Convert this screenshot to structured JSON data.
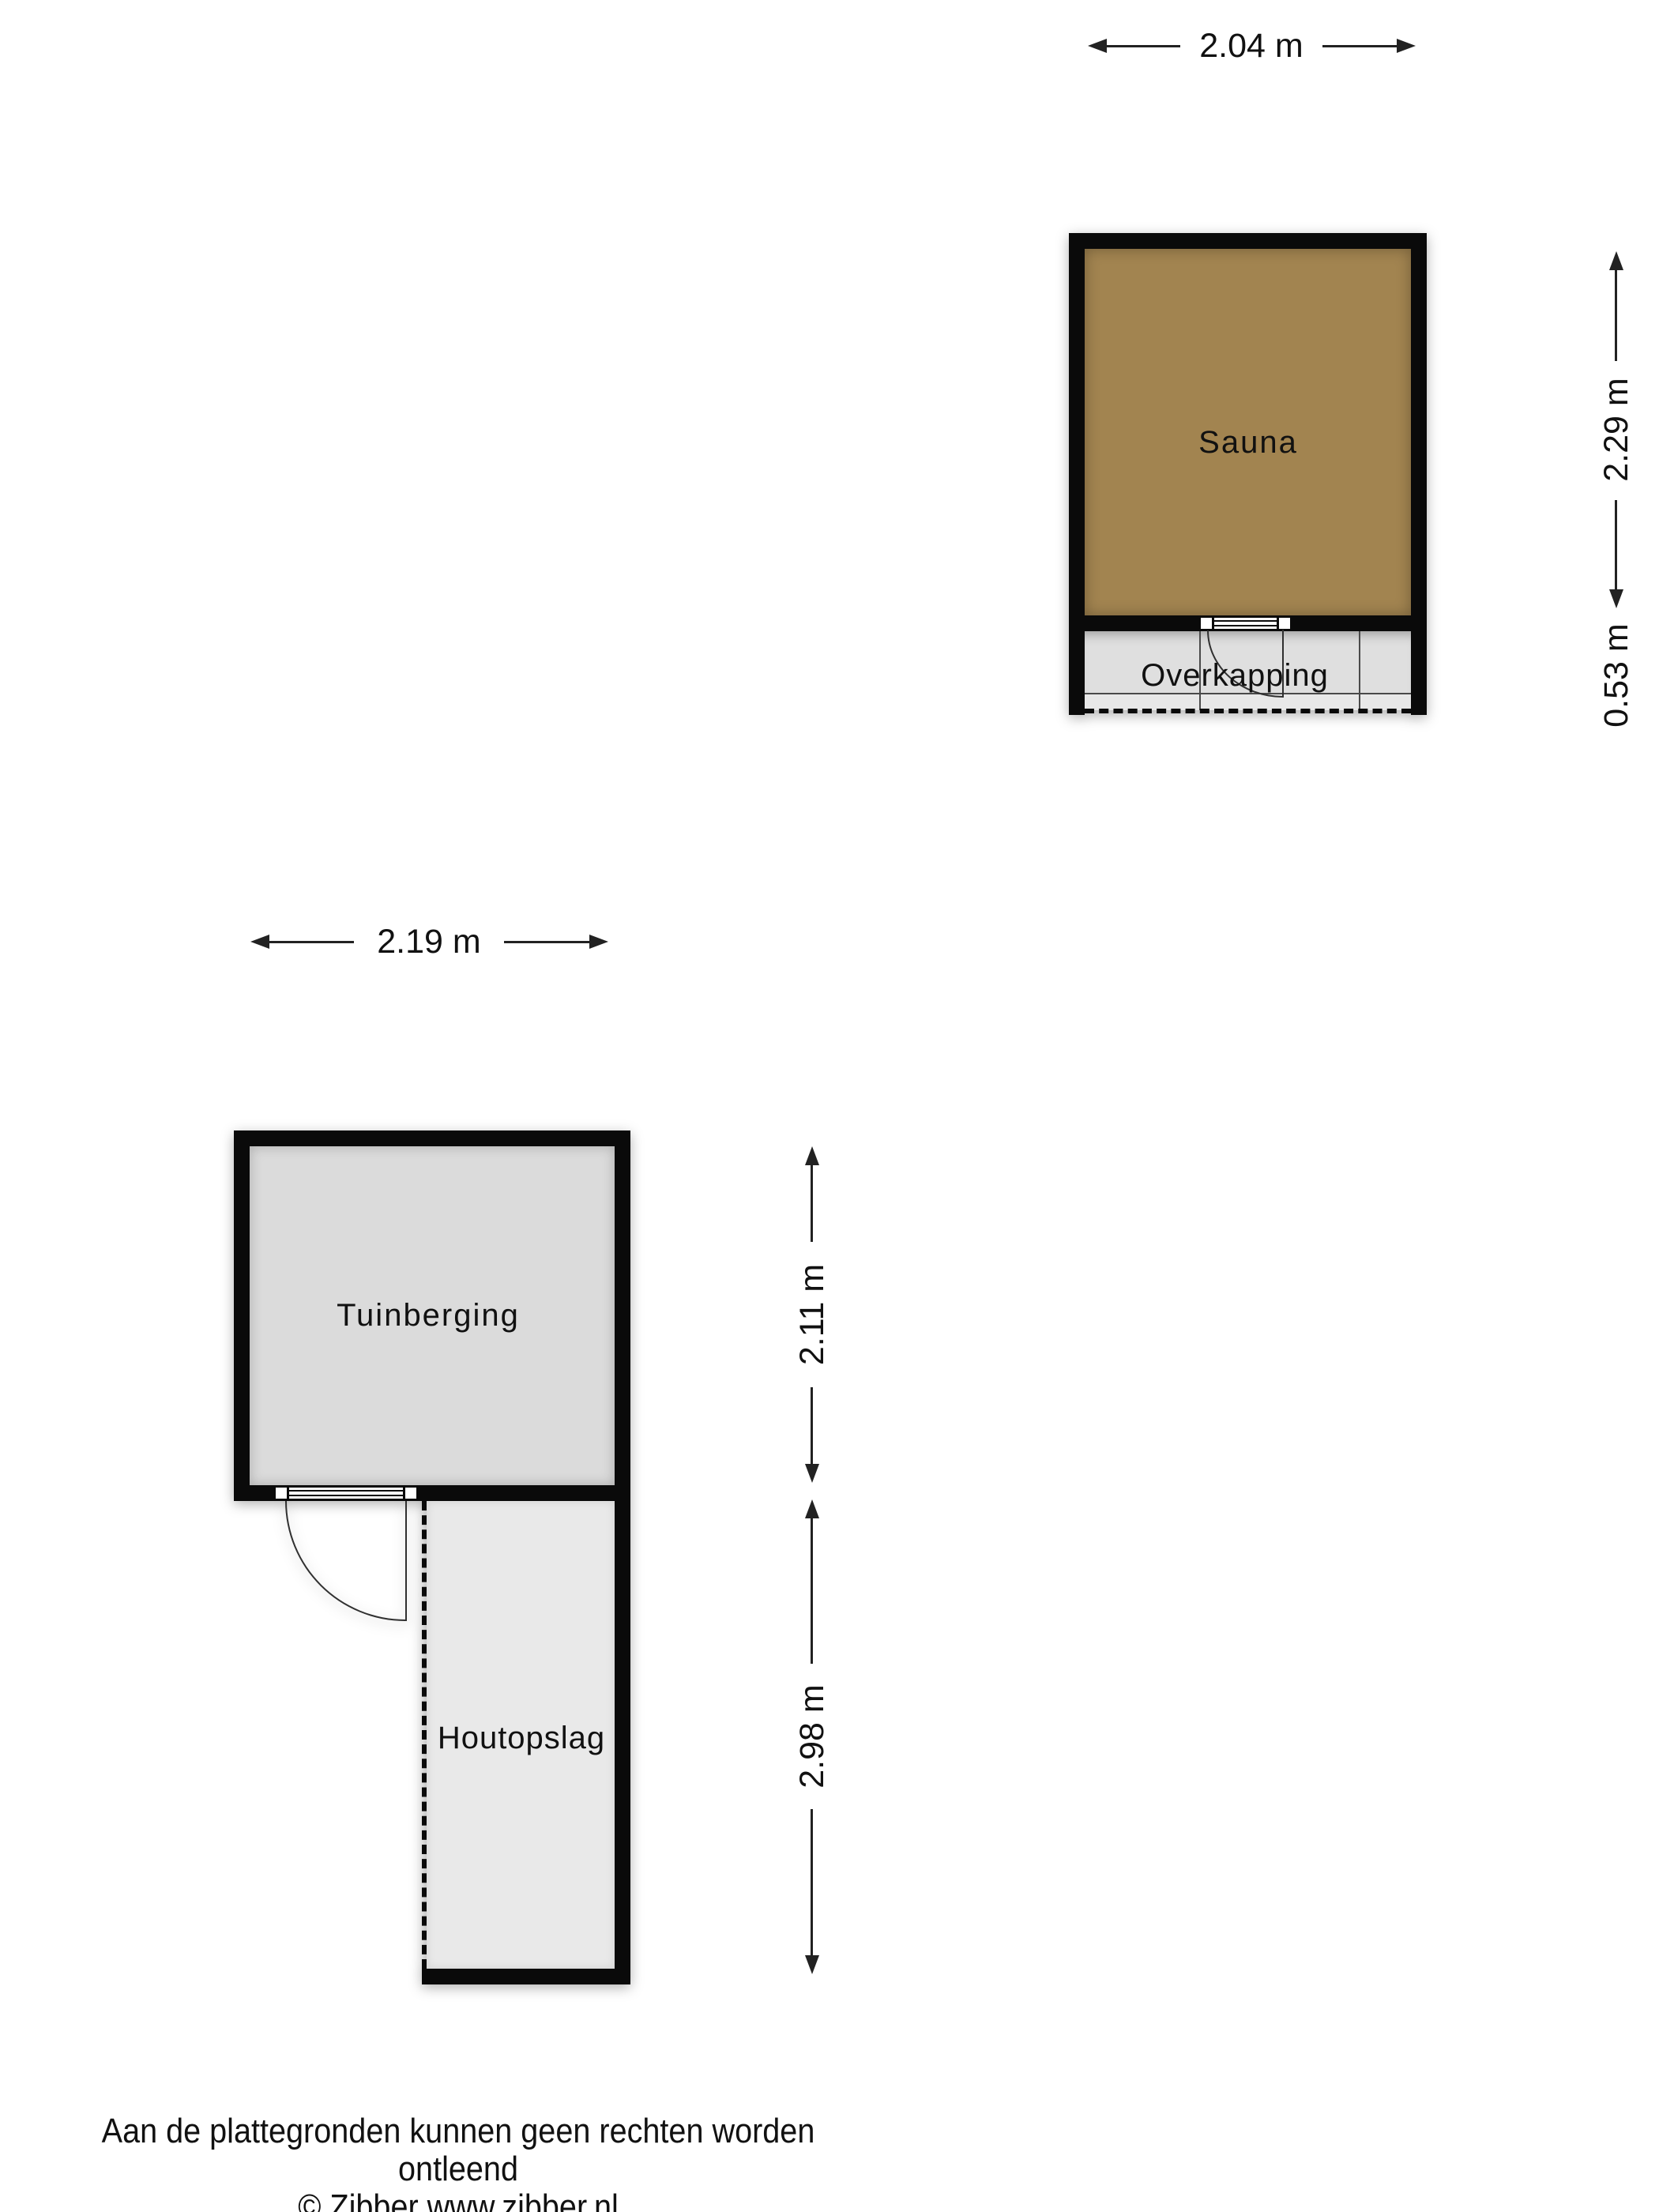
{
  "rooms": {
    "sauna": "Sauna",
    "overkapping": "Overkapping",
    "tuinberging": "Tuinberging",
    "houtopslag": "Houtopslag"
  },
  "dimensions": {
    "sauna_width": "2.04 m",
    "sauna_height": "2.29 m",
    "overkapping_depth": "0.53 m",
    "tuinberging_width": "2.19 m",
    "tuinberging_height": "2.11 m",
    "houtopslag_height": "2.98 m"
  },
  "footer": {
    "disclaimer": "Aan de plattegronden kunnen geen rechten worden ontleend",
    "copyright": "© Zibber www.zibber.nl"
  },
  "colors": {
    "background": "#FFFFFF",
    "wall": "#0A0A0A",
    "line": "#222222",
    "text": "#111111",
    "sauna_fill": "#A28450",
    "tuinberging_fill": "#DBDBDB",
    "overkapping_fill": "#DFDFDF",
    "overkapping_fill_light": "#E8E8E8",
    "houtopslag_fill": "#E9E9E9"
  }
}
